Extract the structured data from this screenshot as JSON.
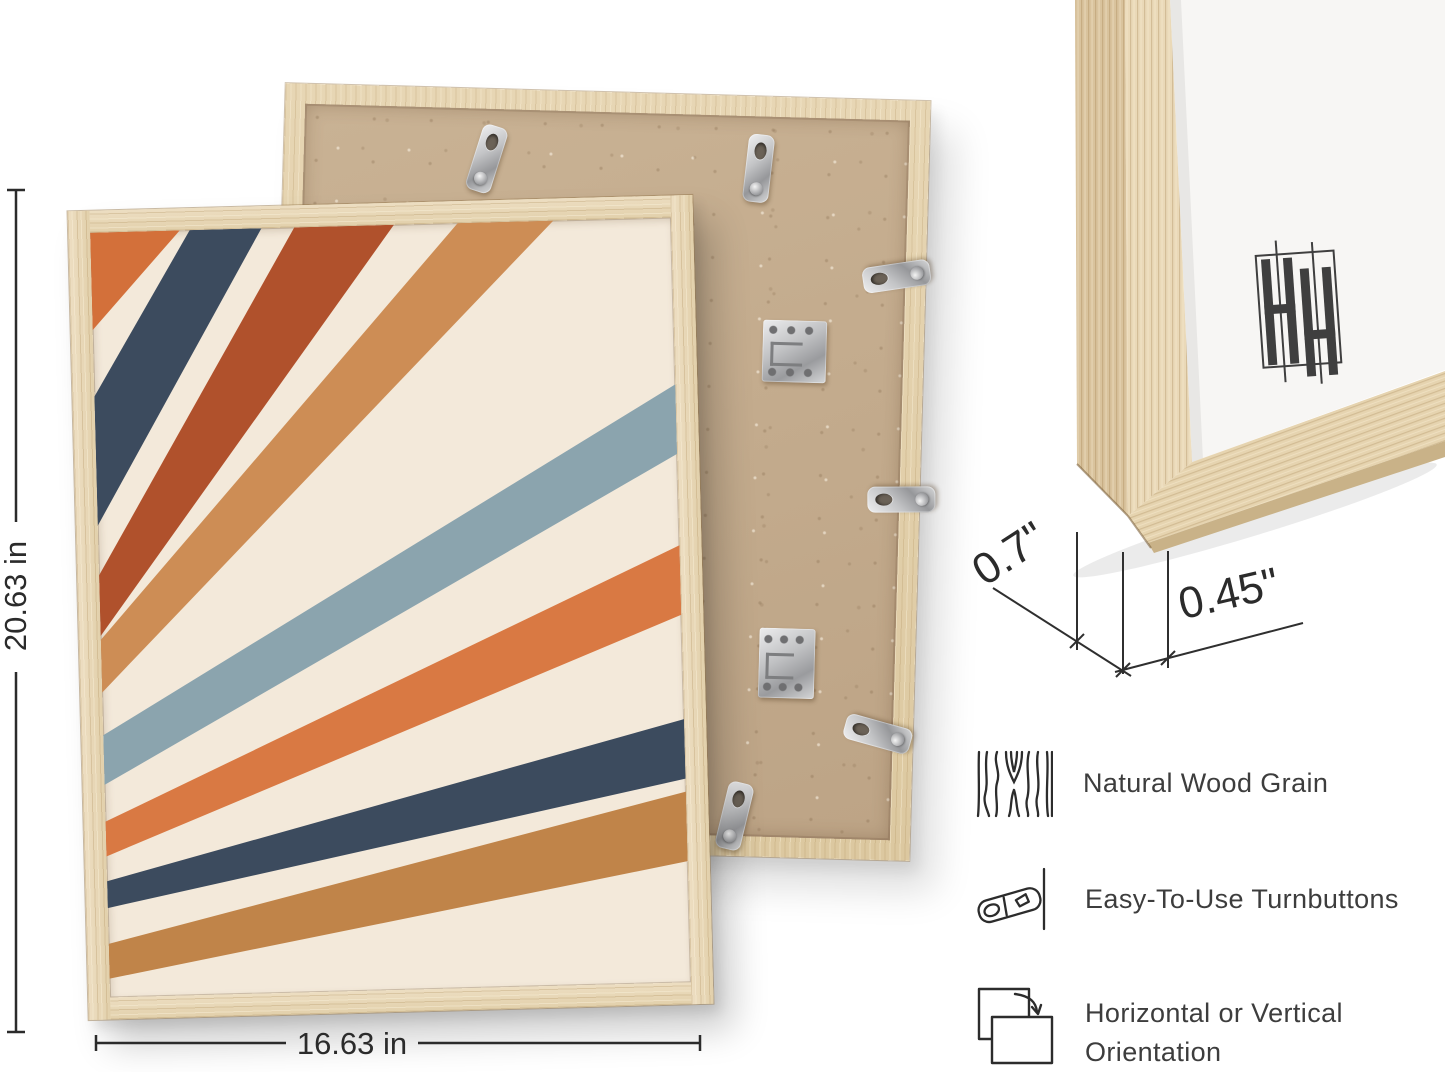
{
  "product": {
    "description": "Natural wood picture frame product infographic",
    "brand_monogram": "HH"
  },
  "dimensions": {
    "height_label": "20.63 in",
    "width_label": "16.63 in",
    "depth_label": "0.7\"",
    "face_label": "0.45\""
  },
  "features": [
    {
      "icon": "wood-grain-icon",
      "label": "Natural Wood Grain"
    },
    {
      "icon": "turnbutton-icon",
      "label": "Easy-To-Use Turnbuttons"
    },
    {
      "icon": "orientation-icon",
      "label_line1": "Horizontal or Vertical",
      "label_line2": "Orientation"
    }
  ],
  "colors": {
    "wood": "#e9d9ba",
    "wood_dark": "#d9c49e",
    "kraft_board": "#c4ac8e",
    "metal": "#c3c4c6",
    "art_cream": "#f3e9da",
    "navy": "#3c4b5e",
    "rust": "#b0512c",
    "orange": "#d97943",
    "tan": "#cd8d55",
    "blue_gray": "#8ba4ae",
    "brown_tan": "#c08449",
    "line": "#2f2f2f",
    "text": "#3d3d3d",
    "mat_white": "#f7f6f4"
  },
  "artwork": {
    "type": "retro sunburst stripes",
    "background": "#f3e9da",
    "stripes": [
      {
        "name": "orange-1",
        "color": "#d3703a",
        "points": "0,0 90,0 0,98"
      },
      {
        "name": "navy-1",
        "color": "#3c4b5e",
        "points": "0,165 100,0 172,0 0,295"
      },
      {
        "name": "rust",
        "color": "#b0512c",
        "points": "0,345 205,0 305,0 0,406"
      },
      {
        "name": "tan-1",
        "color": "#cd8d55",
        "points": "0,410 369,0 465,0 0,463"
      },
      {
        "name": "blue-gray",
        "color": "#8ba4ae",
        "points": "0,506 583,168 583,238 0,556"
      },
      {
        "name": "orange-2",
        "color": "#d97943",
        "points": "0,593 583,330 583,400 0,628"
      },
      {
        "name": "navy-2",
        "color": "#3c4b5e",
        "points": "0,653 583,505 583,565 0,680"
      },
      {
        "name": "tan-2",
        "color": "#c08449",
        "points": "0,716 583,578 583,648 0,751"
      }
    ]
  },
  "back_panel": {
    "hardware": [
      {
        "type": "turnbutton-tab",
        "x": 170,
        "y": 16,
        "w": 26,
        "h": 68,
        "rot": 16
      },
      {
        "type": "turnbutton-tab",
        "x": 442,
        "y": 18,
        "w": 26,
        "h": 68,
        "rot": 5
      },
      {
        "type": "turnbutton-tab",
        "x": 583,
        "y": 122,
        "w": 26,
        "h": 68,
        "rot": -100
      },
      {
        "type": "sawtooth",
        "x": 315,
        "y": 99,
        "w": 52,
        "h": 38,
        "rot": 0
      },
      {
        "type": "z-bracket",
        "x": 464,
        "y": 203,
        "w": 64,
        "h": 62,
        "rot": 0
      },
      {
        "type": "turnbutton-tab",
        "x": 594,
        "y": 345,
        "w": 26,
        "h": 68,
        "rot": -92
      },
      {
        "type": "z-bracket",
        "x": 469,
        "y": 511,
        "w": 56,
        "h": 70,
        "rot": 0
      },
      {
        "type": "turnbutton-tab",
        "x": 577,
        "y": 580,
        "w": 26,
        "h": 68,
        "rot": -76
      },
      {
        "type": "turnbutton-tab",
        "x": 436,
        "y": 666,
        "w": 26,
        "h": 68,
        "rot": 12
      }
    ]
  }
}
